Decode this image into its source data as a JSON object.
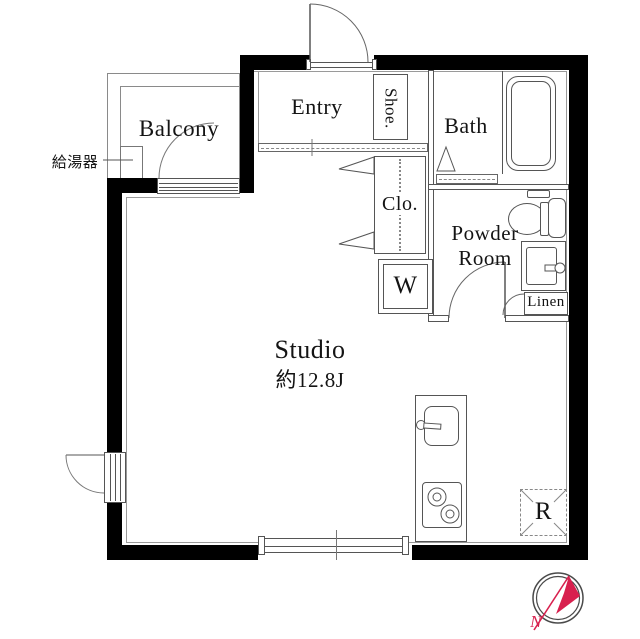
{
  "plan_title": "Studio apartment floor plan",
  "rooms": {
    "balcony": {
      "label": "Balcony"
    },
    "entry": {
      "label": "Entry"
    },
    "shoe": {
      "label": "Shoe."
    },
    "bath": {
      "label": "Bath"
    },
    "closet": {
      "label": "Clo."
    },
    "powder_room": {
      "line1": "Powder",
      "line2": "Room"
    },
    "linen": {
      "label": "Linen"
    },
    "studio": {
      "label": "Studio",
      "area": "約12.8J"
    }
  },
  "fixtures": {
    "washer": {
      "label": "W"
    },
    "refrigerator": {
      "label": "R"
    },
    "water_heater": {
      "label": "給湯器"
    }
  },
  "compass": {
    "north_label": "N",
    "needle_color": "#d8204e",
    "ring_color": "#4a4a4a"
  },
  "colors": {
    "wall": "#000000",
    "line": "#555555",
    "text": "#141414"
  }
}
